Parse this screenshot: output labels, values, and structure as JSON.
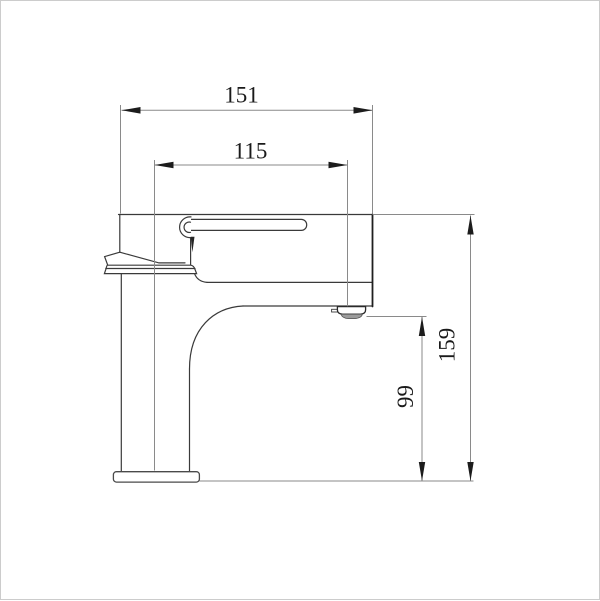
{
  "drawing": {
    "dimensions": {
      "overall_length": "151",
      "spout_reach": "115",
      "overall_height": "159",
      "spout_clearance": "99"
    },
    "colors": {
      "background": "#ffffff",
      "frame_border": "#cccccc",
      "outline": "#3a3a3a",
      "outline_bold": "#1f1f1f",
      "dimension_line": "#8a8a8a",
      "arrow_fill": "#1c1c1c",
      "label_text": "#1a1a1a",
      "aerator_shading": "#9c9c9c"
    }
  }
}
